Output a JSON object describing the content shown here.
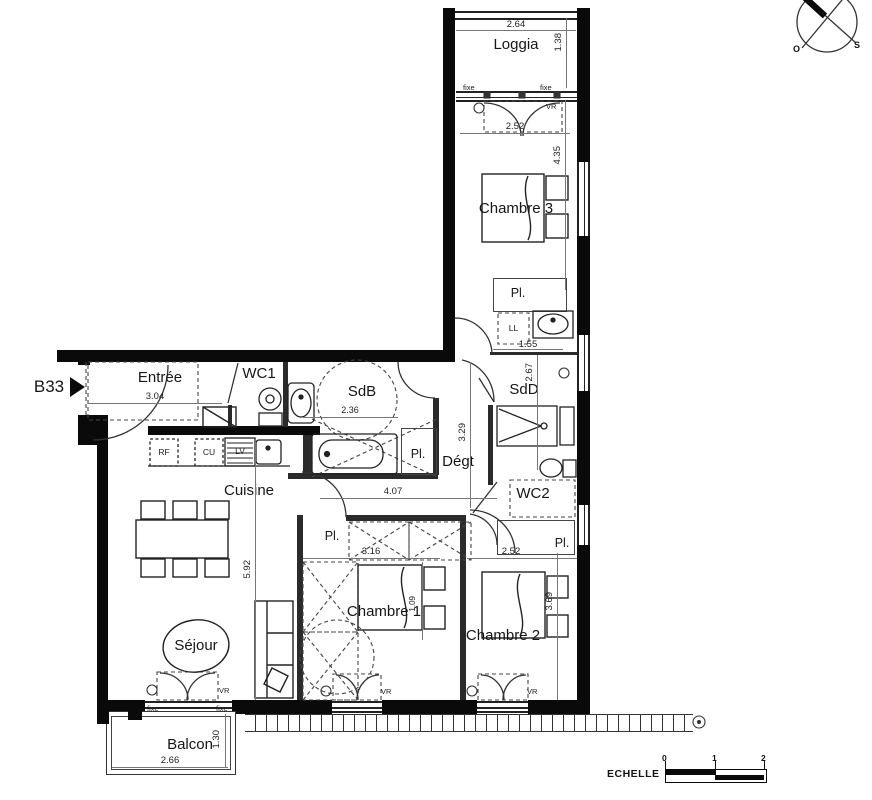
{
  "unit": {
    "label": "B33"
  },
  "rooms": {
    "loggia": "Loggia",
    "chambre3": "Chambre 3",
    "sdb": "SdB",
    "sdd": "SdD",
    "wc1": "WC1",
    "wc2": "WC2",
    "entree": "Entrée",
    "cuisine": "Cuisine",
    "degt": "Dégt",
    "sejour": "Séjour",
    "chambre1": "Chambre 1",
    "chambre2": "Chambre 2",
    "balcon": "Balcon",
    "placard": "Pl."
  },
  "appliances": {
    "ll": "LL",
    "rf": "RF",
    "cu": "CU",
    "lv": "LV"
  },
  "windows": {
    "fixed": "fixe",
    "vr": "VR"
  },
  "dimensions": {
    "loggia_w": "2.64",
    "loggia_d": "1.38",
    "ch3_window": "2.52",
    "ch3_d": "4.35",
    "sink_w": "1.55",
    "sdd_d": "2.67",
    "degt_d": "3.29",
    "sdb_w": "2.36",
    "entree_w": "3.04",
    "hall_w": "4.07",
    "sejour_d": "5.92",
    "ch1_w": "3.16",
    "ch1_d": "1.09",
    "ch2_w": "2.52",
    "ch2_d": "3.69",
    "balcon_w": "2.66",
    "balcon_d": "1.30"
  },
  "scale_bar": {
    "title": "ECHELLE",
    "ticks": [
      "0",
      "1",
      "2"
    ]
  },
  "compass": {
    "west": "O",
    "south": "S"
  }
}
